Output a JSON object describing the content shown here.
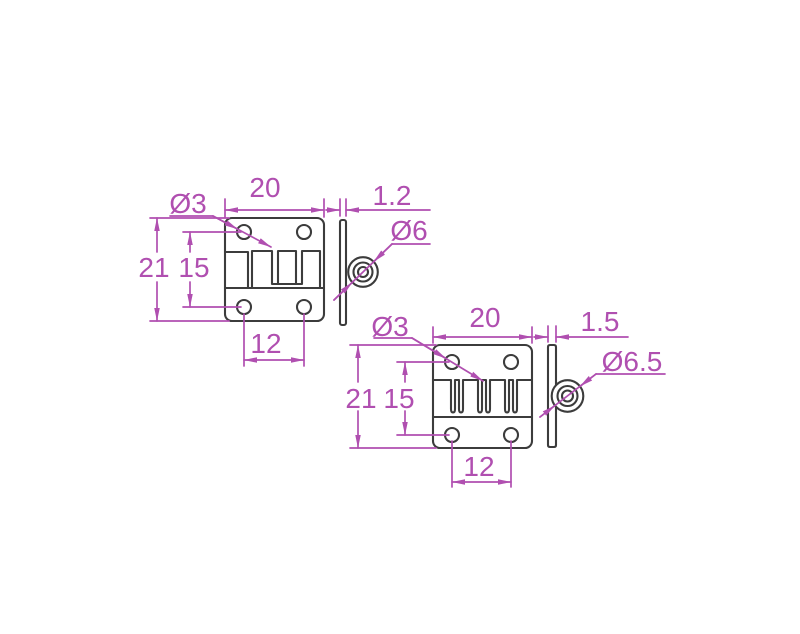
{
  "drawing": {
    "description": "Technical dimension drawing of two butt hinges, front and side views",
    "colors": {
      "outline": "#3c3c3c",
      "dimension": "#b04fb0",
      "background": "#ffffff"
    },
    "hinge_small": {
      "hole_diameter": "Ø3",
      "width": "20",
      "leaf_thickness": "1.2",
      "knuckle_diameter": "Ø6",
      "height": "21",
      "hole_pitch_vertical": "15",
      "hole_pitch_horizontal": "12"
    },
    "hinge_large": {
      "hole_diameter": "Ø3",
      "width": "20",
      "leaf_thickness": "1.5",
      "knuckle_diameter": "Ø6.5",
      "height": "21",
      "hole_pitch_vertical": "15",
      "hole_pitch_horizontal": "12"
    }
  }
}
